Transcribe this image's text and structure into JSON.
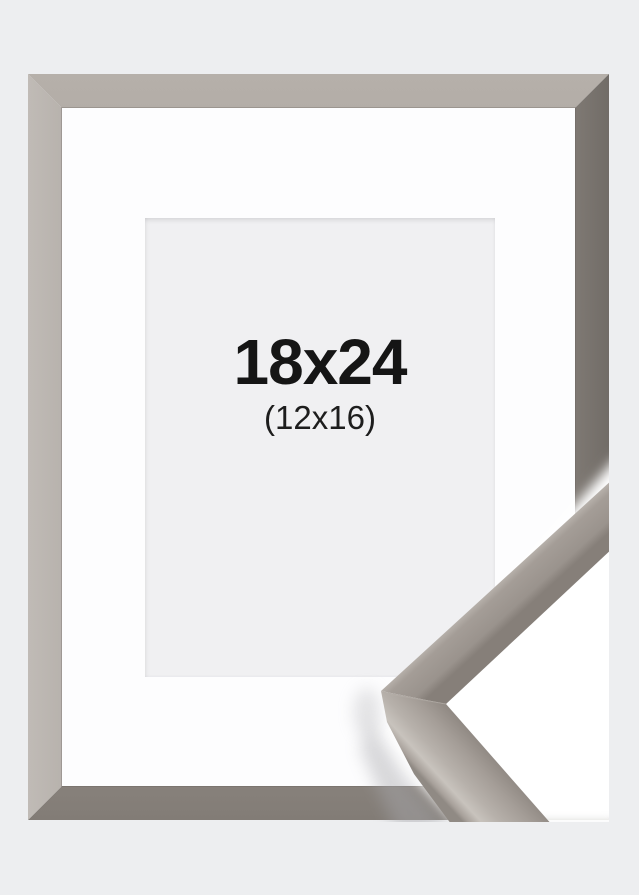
{
  "product": {
    "size_label": "18x24",
    "matted_size_label": "(12x16)"
  },
  "colors": {
    "page_background": "#edeef0",
    "moulding_grey": "#a09a94",
    "moulding_dark": "#837d77",
    "moulding_highlight": "#d5d1cc",
    "mat_white": "#fdfdfe",
    "opening_grey": "#f0f0f2",
    "label_text": "#151515"
  }
}
